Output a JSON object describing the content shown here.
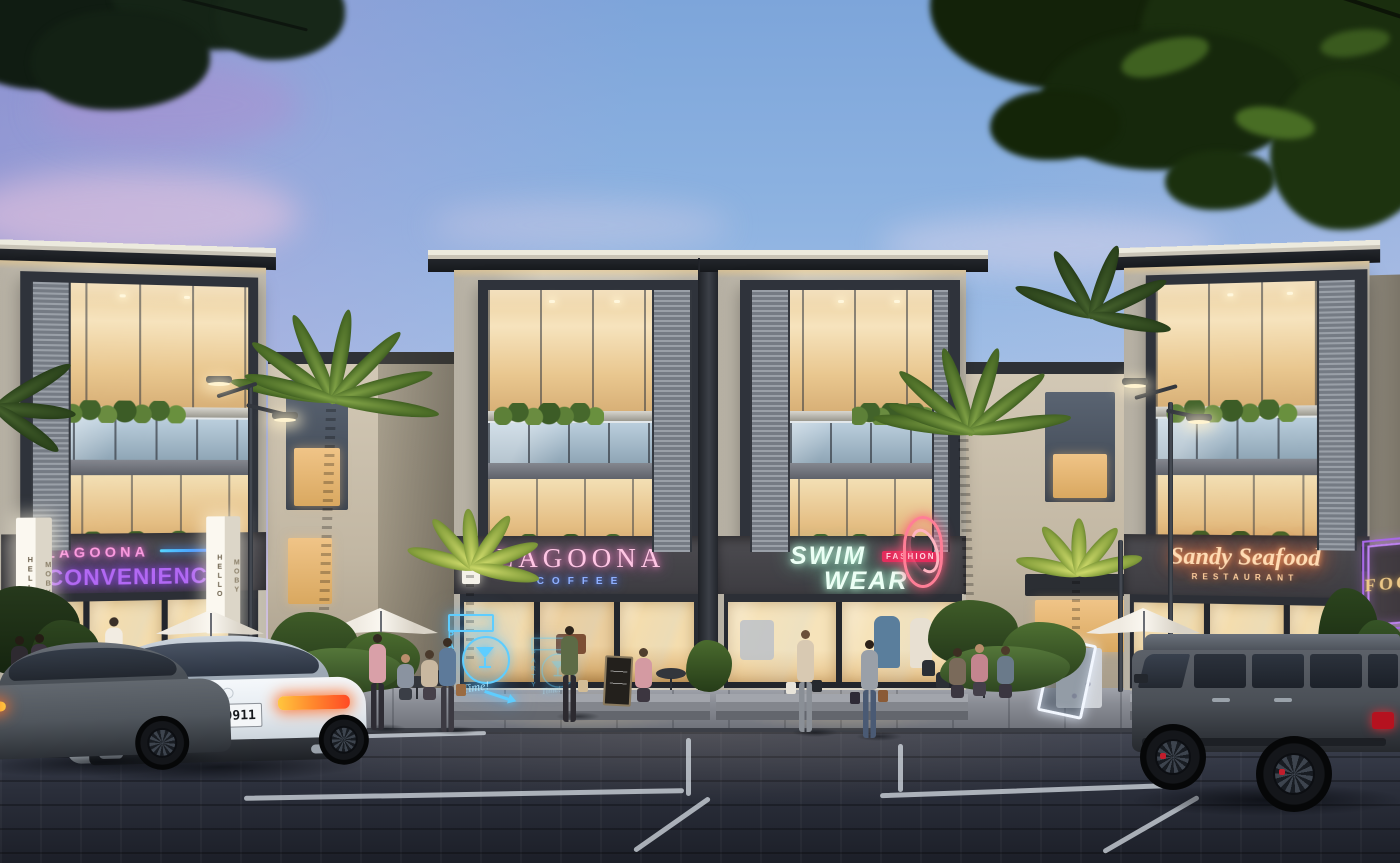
{
  "signs": {
    "hello_moby": {
      "face1": "HELLO",
      "face2": "MOBY"
    },
    "convenience": {
      "brand": "LAGOONA",
      "word": "CONVENIENCE"
    },
    "coffee": {
      "brand": "LAGOONA",
      "word": "COFFEE"
    },
    "party_neon": {
      "vertical": "PARTY",
      "script": "Time!"
    },
    "swimwear": {
      "line1": "SWIM",
      "line2": "WEAR",
      "badge": "FASHION"
    },
    "seafood": {
      "script": "Sandy Seafood",
      "sub": "RESTAURANT"
    },
    "food_blade": {
      "word": "FOOD"
    },
    "address_number": {
      "digits": "073"
    }
  },
  "vehicles": {
    "white_coupe": {
      "license_plate": "S•HG 9911"
    }
  },
  "palette": {
    "sky_blue": "#8bb1e0",
    "sky_pink": "#f0d8e2",
    "sky_purple": "#9e7ac4",
    "facade_cream": "#d8d2c3",
    "frame_dark": "#2f333b",
    "interior_warm": "#f2d9a8",
    "neon_pink": "#ff9fe0",
    "neon_purple": "#b268f4",
    "neon_blue": "#5ecdff",
    "neon_mint": "#ecfff5",
    "neon_red": "#ff7e96",
    "neon_orange": "#ffdcb4",
    "neon_gold": "#ecc887",
    "sign_band": "#46454a",
    "pavement": "#2a2e3a",
    "sidewalk": "#898c94"
  }
}
